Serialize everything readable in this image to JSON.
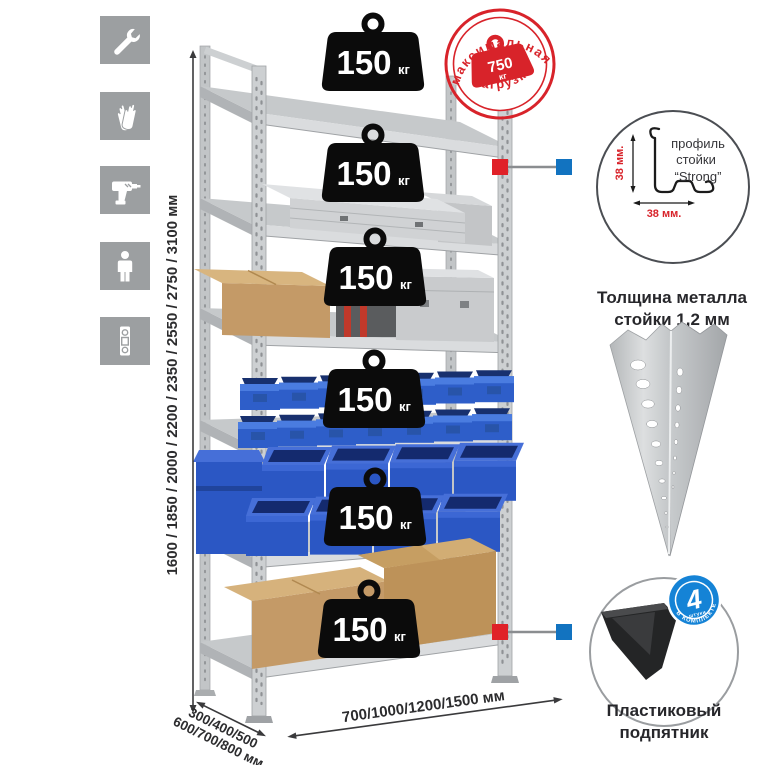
{
  "sidebar": {
    "icons": [
      {
        "name": "wrench-icon"
      },
      {
        "name": "gloves-icon"
      },
      {
        "name": "drill-icon"
      },
      {
        "name": "person-icon"
      },
      {
        "name": "spirit-level-icon"
      }
    ]
  },
  "dimensions": {
    "height": "1600 / 1850 / 2000 / 2200 / 2350 / 2550 / 2750 / 3100 мм",
    "depth_line1": "300/400/500",
    "depth_line2": "600/700/800 мм",
    "width": "700/1000/1200/1500 мм"
  },
  "shelf": {
    "count": 6,
    "badge_value": "150",
    "badge_unit": "кг"
  },
  "stamp": {
    "arc_top": "максимальная",
    "arc_bottom": "нагрузка",
    "value": "750",
    "unit": "кг"
  },
  "profile_detail": {
    "label_line1": "профиль",
    "label_line2": "стойки",
    "label_line3": "“Strong”",
    "dim_vertical": "38 мм.",
    "dim_horizontal": "38 мм.",
    "caption_line1": "Толщина металла",
    "caption_line2": "стойки 1,2 мм"
  },
  "foot_detail": {
    "badge_value": "4",
    "badge_sub": "штуки",
    "badge_arc": "в комплекте",
    "caption_line1": "Пластиковый",
    "caption_line2": "подпятник"
  },
  "colors": {
    "accent_red": "#d8232a",
    "marker_blue": "#1273c0",
    "bin_blue": "#2b57c4",
    "metal_gray": "#cdd0d2",
    "tile_gray": "#9c9fa1",
    "cardboard": "#c49a67"
  }
}
